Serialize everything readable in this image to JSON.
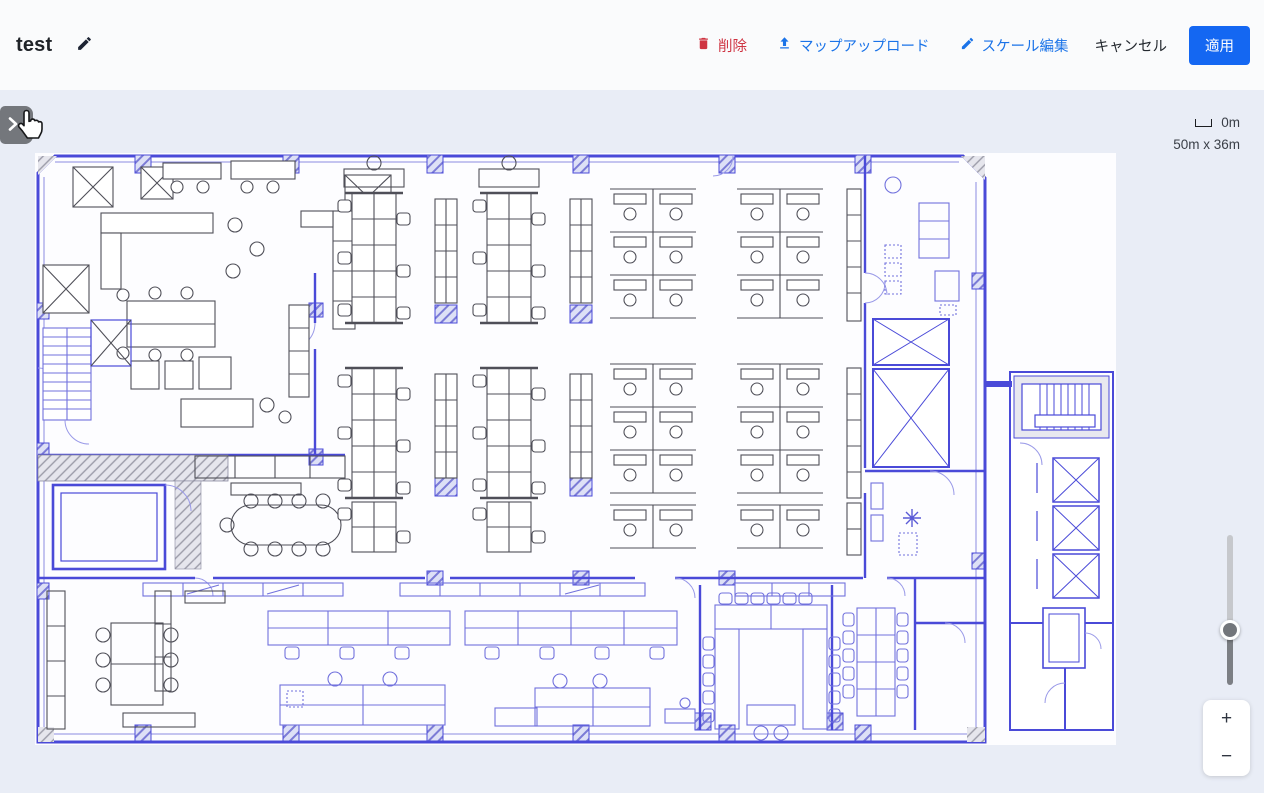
{
  "header": {
    "title": "test",
    "actions": {
      "delete_label": "削除",
      "upload_label": "マップアップロード",
      "scale_edit_label": "スケール編集",
      "cancel_label": "キャンセル",
      "apply_label": "適用"
    }
  },
  "map": {
    "scale_value": "0m",
    "dimensions": "50m x 36m"
  },
  "zoom_controls": {
    "zoom_in": "+",
    "zoom_out": "−"
  },
  "colors": {
    "accent_blue": "#1a73e8",
    "danger_red": "#cf3442",
    "apply_button_blue": "#1467f2",
    "plan_wall_blue": "#4a4ad8"
  }
}
